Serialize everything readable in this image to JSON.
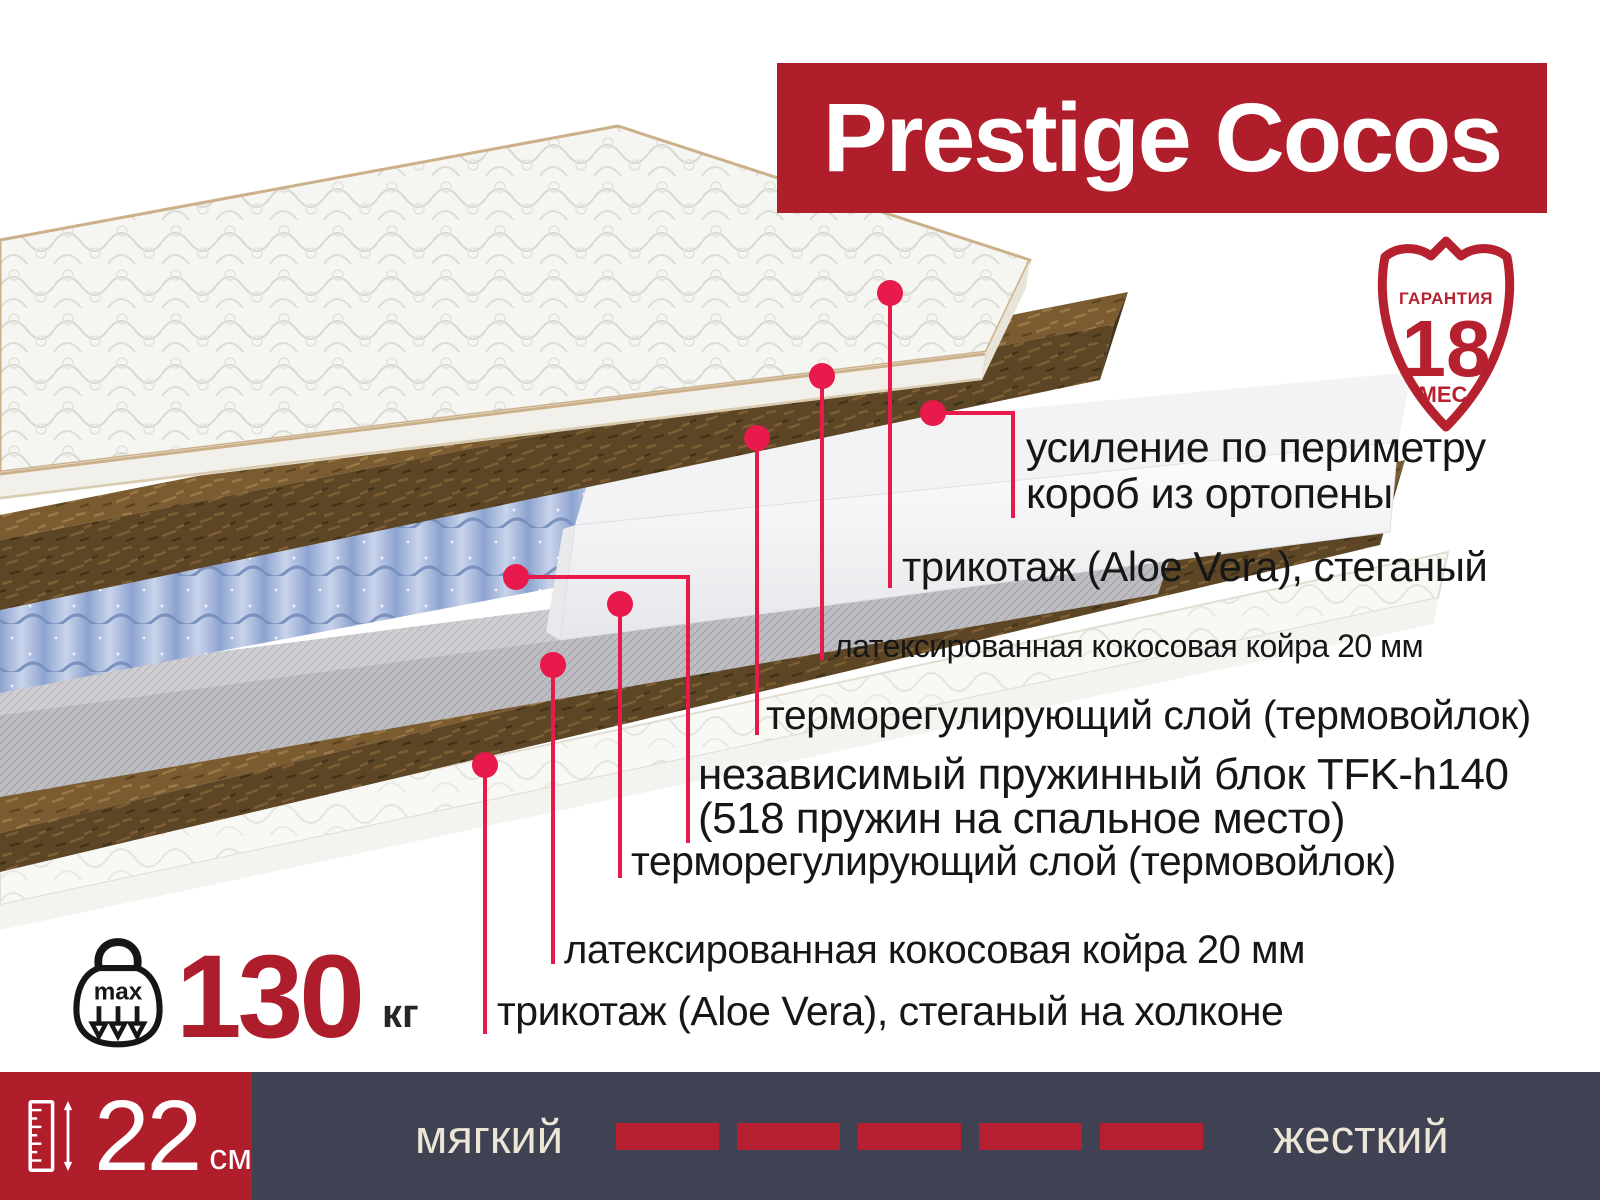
{
  "title": "Prestige Cocos",
  "warranty_badge": {
    "icon": "warranty-shield-icon",
    "top": "ГАРАНТИЯ",
    "value": "18",
    "bottom": "МЕС."
  },
  "callouts": [
    {
      "lines": [
        "усиление по периметру",
        "короб из ортопены"
      ]
    },
    {
      "lines": [
        "трикотаж (Aloe Vera), стеганый"
      ]
    },
    {
      "lines": [
        "латексированная кокосовая койра 20 мм"
      ]
    },
    {
      "lines": [
        "терморегулирующий слой (термовойлок)"
      ]
    },
    {
      "lines": [
        "независимый пружинный блок TFK-h140",
        "(518 пружин на спальное место)"
      ]
    },
    {
      "lines": [
        "терморегулирующий слой (термовойлок)"
      ]
    },
    {
      "lines": [
        "латексированная кокосовая койра 20 мм"
      ]
    },
    {
      "lines": [
        "трикотаж (Aloe Vera), стеганый на холконе"
      ]
    }
  ],
  "max_weight": {
    "icon": "kettlebell-max-weight-icon",
    "icon_label": "max",
    "value": "130",
    "unit": "кг"
  },
  "height": {
    "icon": "ruler-height-icon",
    "value": "22",
    "unit": "см"
  },
  "firmness_scale": {
    "left_label": "мягкий",
    "right_label": "жесткий",
    "segments": 5
  },
  "colors": {
    "brand-red": "#b01e2c",
    "dark-red": "#ae1d2b",
    "shield-red": "#b5212e",
    "accent-red": "#e8194b",
    "bar-bg": "#3e4252",
    "bar-red": "#b51f2f",
    "cream": "#ede6d7",
    "text": "#161616"
  }
}
